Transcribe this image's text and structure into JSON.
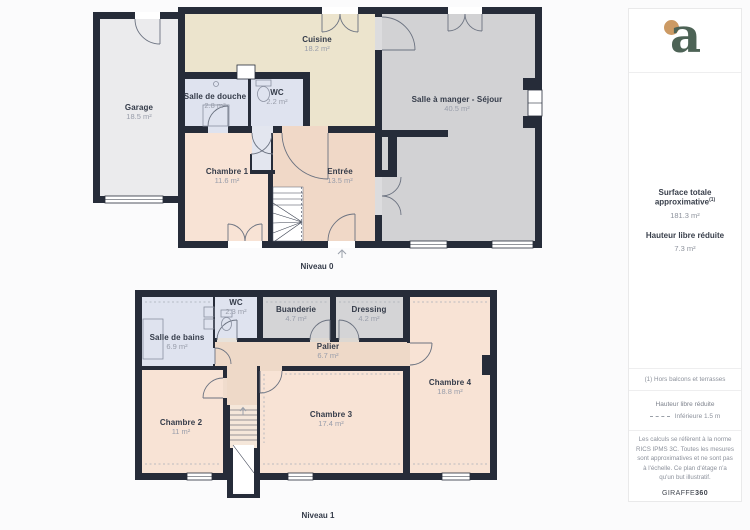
{
  "floors": [
    {
      "label": "Niveau 0",
      "rooms": [
        {
          "name": "Garage",
          "area": "18.5 m²"
        },
        {
          "name": "Cuisine",
          "area": "18.2 m²"
        },
        {
          "name": "Salle de douche",
          "area": "2.8 m²"
        },
        {
          "name": "WC",
          "area": "2.2 m²"
        },
        {
          "name": "Salle à manger - Séjour",
          "area": "40.5 m²"
        },
        {
          "name": "Chambre 1",
          "area": "11.6 m²"
        },
        {
          "name": "Entrée",
          "area": "13.5 m²"
        }
      ]
    },
    {
      "label": "Niveau 1",
      "rooms": [
        {
          "name": "Salle de bains",
          "area": "6.9 m²"
        },
        {
          "name": "WC",
          "area": "2.3 m²"
        },
        {
          "name": "Buanderie",
          "area": "4.7 m²"
        },
        {
          "name": "Dressing",
          "area": "4.2 m²"
        },
        {
          "name": "Palier",
          "area": "6.7 m²"
        },
        {
          "name": "Chambre 2",
          "area": "11 m²"
        },
        {
          "name": "Chambre 3",
          "area": "17.4 m²"
        },
        {
          "name": "Chambre 4",
          "area": "18.8 m²"
        }
      ]
    }
  ],
  "sidebar": {
    "logo_letter": "a",
    "surface_label": "Surface totale approximative",
    "surface_sup": "(1)",
    "surface_value": "181.3 m²",
    "hauteur_label": "Hauteur libre réduite",
    "hauteur_value": "7.3 m²",
    "footnote": "(1) Hors balcons et terrasses",
    "legend_title": "Hauteur libre réduite",
    "legend_value": "Inférieure 1.5 m",
    "disclaimer": "Les calculs se réfèrent à la norme RICS IPMS 3C. Toutes les mesures sont approximatives et ne sont pas à l'échelle. Ce plan d'étage n'a qu'un but illustratif.",
    "brand": "GIRAFFE",
    "brand_bold": "360"
  },
  "colors": {
    "wall": "#262c39",
    "room_peach": "#f8e3d5",
    "room_tan": "#f0d8c7",
    "room_gray": "#d2d2d4",
    "room_blue": "#dfe3ef",
    "room_beige": "#ece4cd",
    "room_garage": "#ebebed",
    "logo_green": "#4d6356",
    "logo_orange": "#cc9a64"
  }
}
